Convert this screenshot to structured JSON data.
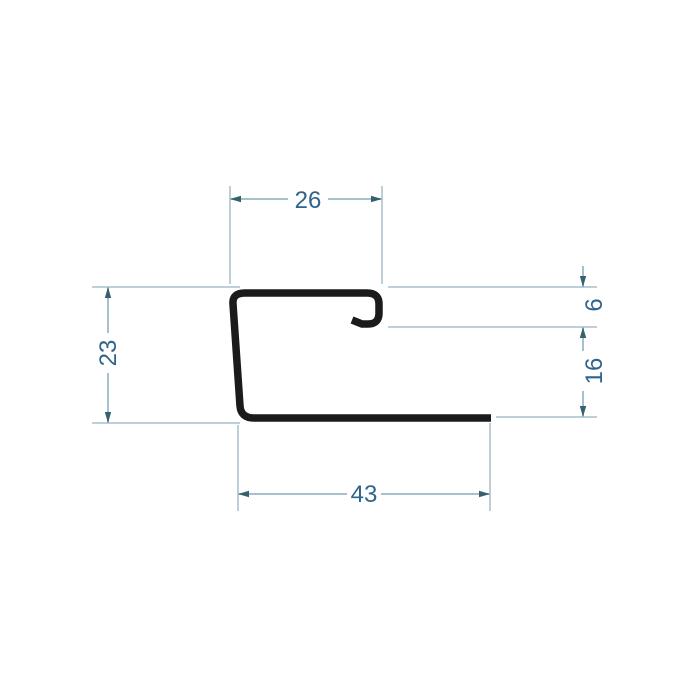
{
  "drawing": {
    "kind": "technical-cross-section",
    "colors": {
      "background": "#ffffff",
      "profile": "#1b1b1b",
      "dimension_line": "#a7c0cd",
      "dimension_text": "#2f648c",
      "arrow": "#35616f"
    },
    "dimensions": [
      {
        "id": "top-flange-width",
        "value": "26",
        "orientation": "horizontal"
      },
      {
        "id": "profile-height",
        "value": "23",
        "orientation": "vertical"
      },
      {
        "id": "hook-return-depth",
        "value": "6",
        "orientation": "vertical"
      },
      {
        "id": "opening-height",
        "value": "16",
        "orientation": "vertical"
      },
      {
        "id": "bottom-flange-width",
        "value": "43",
        "orientation": "horizontal"
      }
    ]
  }
}
